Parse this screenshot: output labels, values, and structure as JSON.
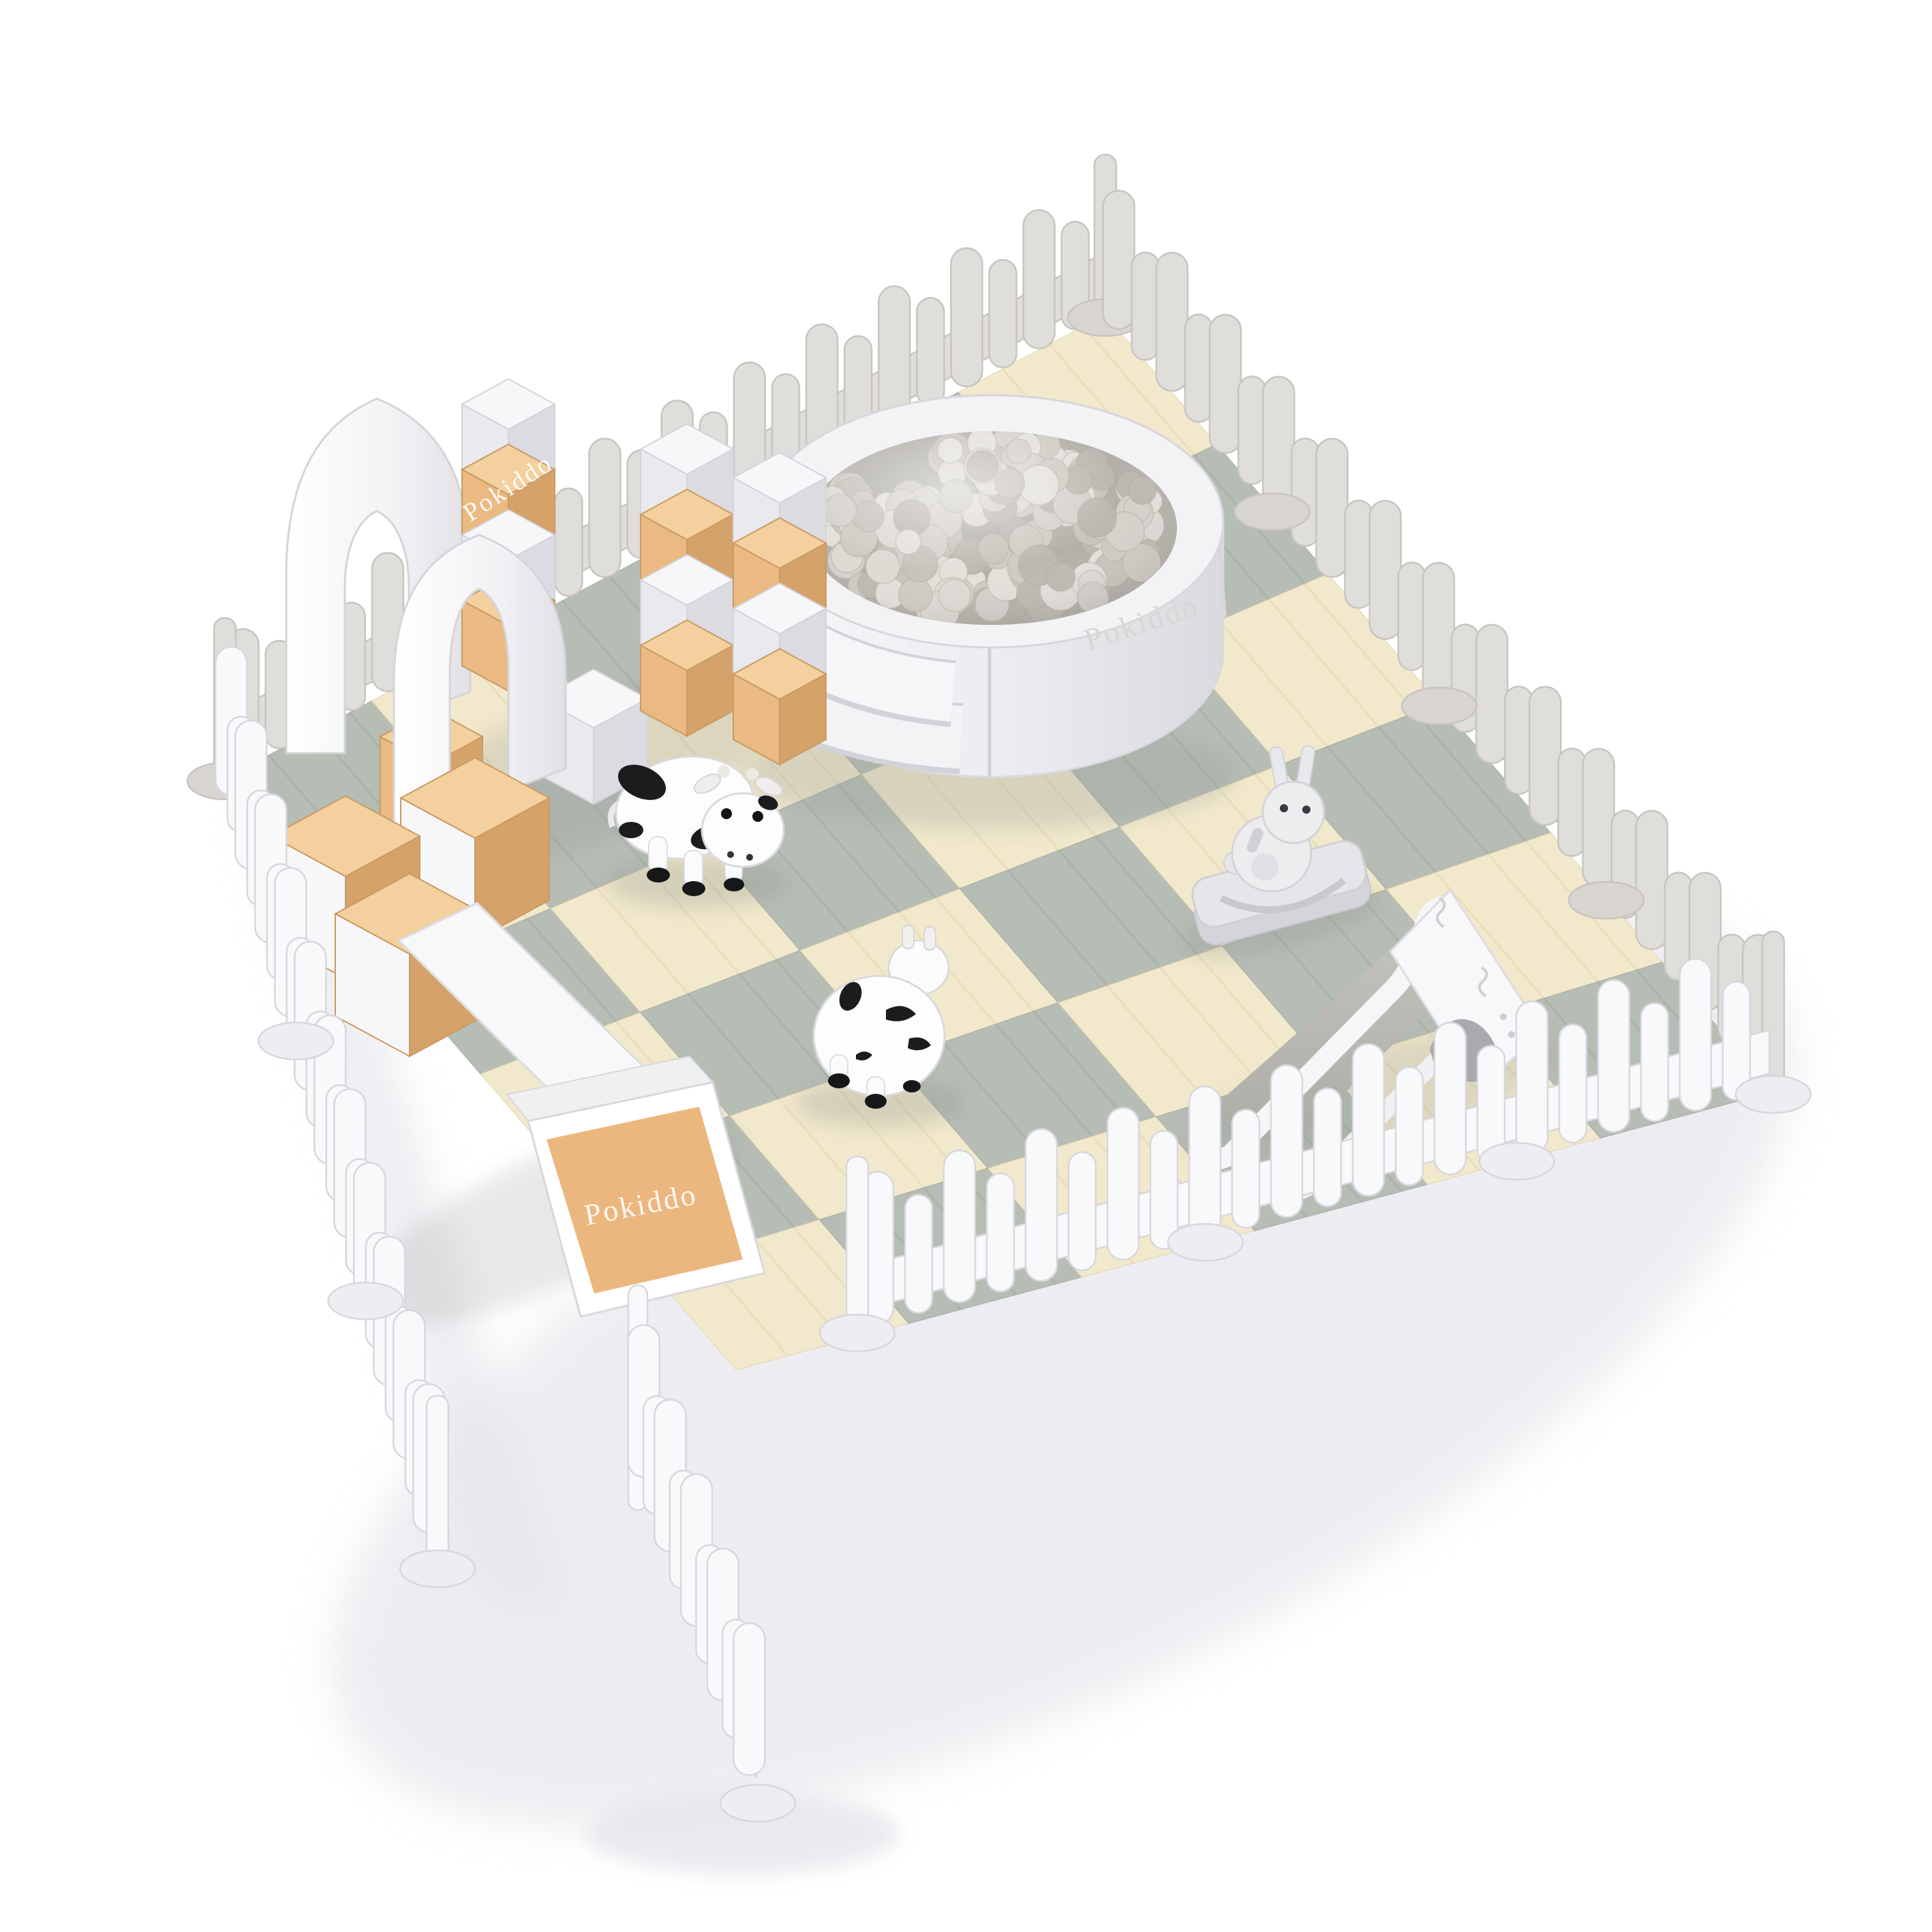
{
  "scene": {
    "name": "pokiddo-toddler-soft-play-pen-product-render",
    "brand": "Pokiddo",
    "background": "#ffffff",
    "description": "3D render of a fenced toddler soft play area with foam mats, ball pit, soft blocks, slide and animal hopper toys"
  },
  "watermarks": [
    {
      "location": "ball-pit-wall",
      "text": "Pokiddo"
    },
    {
      "location": "soft-block-tower",
      "text": "Pokiddo"
    },
    {
      "location": "foam-ramp",
      "text": "Pokiddo"
    }
  ],
  "palette": {
    "fence_front": "#f9f9fb",
    "fence_front_stroke": "#d7d7dd",
    "fence_front_foot": "#eeeef2",
    "fence_back": "#e0deda",
    "fence_back_stroke": "#c8c5c1",
    "fence_back_foot": "#d8d5d1",
    "mat_cream": "#f2e9cc",
    "mat_cream_streak": "#dfd2a9",
    "mat_gray": "#b6bdb5",
    "mat_gray_streak": "#9da59d",
    "block_white": "#f7f7f9",
    "block_white_side": "#e9e9ee",
    "block_white_dark": "#dbdbe1",
    "block_stroke": "#d4d4da",
    "tan_top": "#f3d09e",
    "tan_left": "#eaba82",
    "tan_right": "#d5a26a",
    "tan_stroke": "#c99b64",
    "pool_body": "#f2f2f5",
    "pool_shade": "#dcdce2",
    "ball_bed": "#b3b0a9",
    "balls": [
      "#d4d0ca",
      "#c7c3bc",
      "#ddd9d3",
      "#bcb8b1",
      "#cecac3",
      "#e3e0da"
    ],
    "slide_bed": "#b5b3ae",
    "toy_white": "#fdfdfe",
    "toy_stroke": "#d8d8dc",
    "toy_gray": "#e6e6ea",
    "toy_gray_dark": "#cccdd2",
    "cow_spot": "#1c1c1f",
    "shadow": "#dfdfe6",
    "mat_shadow": "#8d948d"
  },
  "floor": {
    "grid": 6,
    "corners": {
      "left": [
        330,
        1142
      ],
      "top": [
        1622,
        462
      ],
      "right": [
        2602,
        1602
      ],
      "bottom": [
        1080,
        2010
      ]
    }
  },
  "objects": [
    {
      "name": "picket-fence-enclosure"
    },
    {
      "name": "open-gate-panel"
    },
    {
      "name": "interlocking-foam-mat-floor"
    },
    {
      "name": "round-ball-pit-with-steps"
    },
    {
      "name": "soft-block-arches-and-towers"
    },
    {
      "name": "foam-climb-and-slide-set-with-ramp"
    },
    {
      "name": "toddler-slide"
    },
    {
      "name": "cow-hopper-toy-side"
    },
    {
      "name": "cow-hopper-toy-back"
    },
    {
      "name": "bunny-rocker-toy"
    }
  ]
}
